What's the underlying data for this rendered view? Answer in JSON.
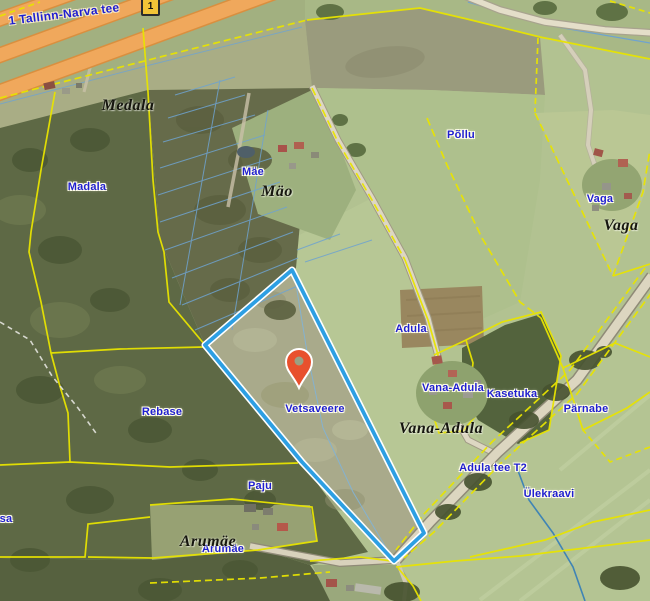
{
  "map": {
    "road_badge": {
      "number": "1"
    },
    "road_label": {
      "text": "1 Tallinn-Narva tee",
      "x": 64,
      "y": 14,
      "angle": -7
    },
    "labels": {
      "place": [
        {
          "text": "Madala",
          "x": 87,
          "y": 187
        },
        {
          "text": "Mäe",
          "x": 253,
          "y": 172
        },
        {
          "text": "Põllu",
          "x": 461,
          "y": 135
        },
        {
          "text": "Vaga",
          "x": 600,
          "y": 199
        },
        {
          "text": "Adula",
          "x": 411,
          "y": 329
        },
        {
          "text": "Vana-Adula",
          "x": 453,
          "y": 388
        },
        {
          "text": "Kasetuka",
          "x": 512,
          "y": 394
        },
        {
          "text": "Pärnabe",
          "x": 586,
          "y": 409
        },
        {
          "text": "Rebase",
          "x": 162,
          "y": 412
        },
        {
          "text": "Vetsaveere",
          "x": 315,
          "y": 409
        },
        {
          "text": "Paju",
          "x": 260,
          "y": 486
        },
        {
          "text": "Arumäe",
          "x": 223,
          "y": 549
        },
        {
          "text": "Adula tee T2",
          "x": 493,
          "y": 468
        },
        {
          "text": "Ülekraavi",
          "x": 549,
          "y": 494
        },
        {
          "text": "sa",
          "x": 6,
          "y": 519
        }
      ],
      "village": [
        {
          "text": "Medala",
          "x": 128,
          "y": 106
        },
        {
          "text": "Mäo",
          "x": 277,
          "y": 192
        },
        {
          "text": "Vaga",
          "x": 621,
          "y": 226
        },
        {
          "text": "Vana-Adula",
          "x": 441,
          "y": 429
        },
        {
          "text": "Arumäe",
          "x": 208,
          "y": 542
        }
      ]
    },
    "parcel_highlight": {
      "points": [
        [
          292,
          270
        ],
        [
          424,
          533
        ],
        [
          394,
          561
        ],
        [
          302,
          462
        ],
        [
          205,
          345
        ]
      ],
      "stroke": "#2D9FE3",
      "casing": "#ffffff"
    },
    "marker": {
      "x": 299,
      "tip_y": 388,
      "color": "#E8502D",
      "hole": "#9aa083"
    },
    "colors": {
      "cadastral_line": "#e8e400",
      "highway": "#f0a85c",
      "stream": "#3f84b5",
      "field": "#b2c291",
      "forest": "#5e6945"
    }
  }
}
